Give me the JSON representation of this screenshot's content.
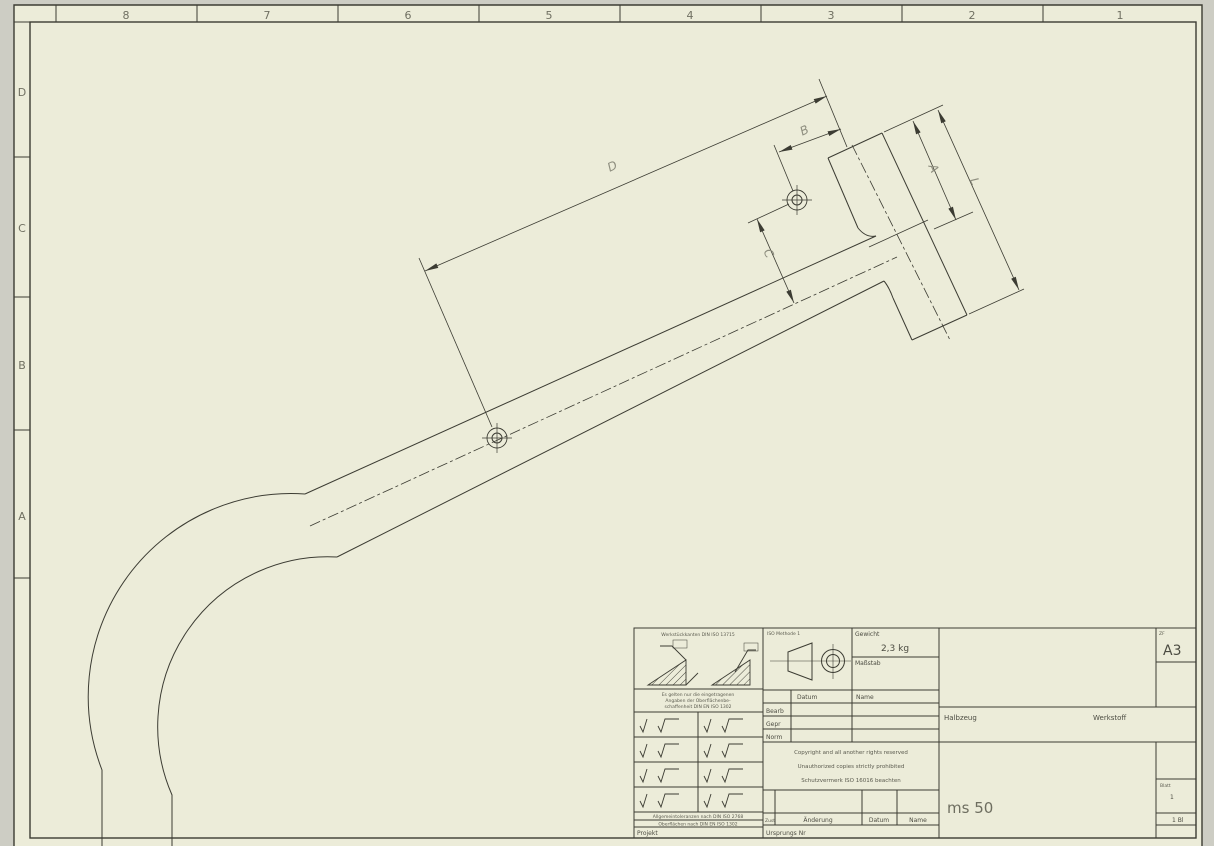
{
  "sheet": {
    "format_label": "ZF",
    "format": "A3",
    "border": {
      "top_zones": [
        "8",
        "7",
        "6",
        "5",
        "4",
        "3",
        "2",
        "1"
      ],
      "side_zones": [
        "D",
        "C",
        "B",
        "A"
      ]
    }
  },
  "drawing": {
    "dimension_labels": {
      "d": "D",
      "b": "B",
      "c": "C",
      "a": "A",
      "l": "L"
    }
  },
  "title_block": {
    "edges_note": "Werkstückkanten DIN ISO 13715",
    "surface_note_lines": [
      "Es gelten nur die eingetragenen",
      "Angaben der Oberflächenbe-",
      "schaffenheit DIN EN ISO 1302"
    ],
    "tolerance_note_line1": "Allgemeintoleranzen nach DIN ISO 2768",
    "tolerance_note_line2": "Oberflächen nach DIN EN ISO 1302",
    "projekt_label": "Projekt",
    "projection_label": "ISO Methode 1",
    "gewicht_label": "Gewicht",
    "gewicht_value": "2,3 kg",
    "massstab_label": "Maßstab",
    "datum_label": "Datum",
    "name_label": "Name",
    "bearb_label": "Bearb",
    "gepr_label": "Gepr",
    "norm_label": "Norm",
    "copyright_line1": "Copyright and all another rights reserved",
    "copyright_line2": "Unauthorized copies strictly prohibited",
    "copyright_line3": "Schutzvermerk ISO 16016 beachten",
    "zust_label": "Zust",
    "aenderung_label": "Änderung",
    "datum2_label": "Datum",
    "name2_label": "Name",
    "ursprung_label": "Ursprungs Nr",
    "halbzeug_label": "Halbzeug",
    "werkstoff_label": "Werkstoff",
    "part_name": "ms 50",
    "blatt_label": "Blatt",
    "blatt_value": "1",
    "blatt_count": "1 Bl"
  }
}
